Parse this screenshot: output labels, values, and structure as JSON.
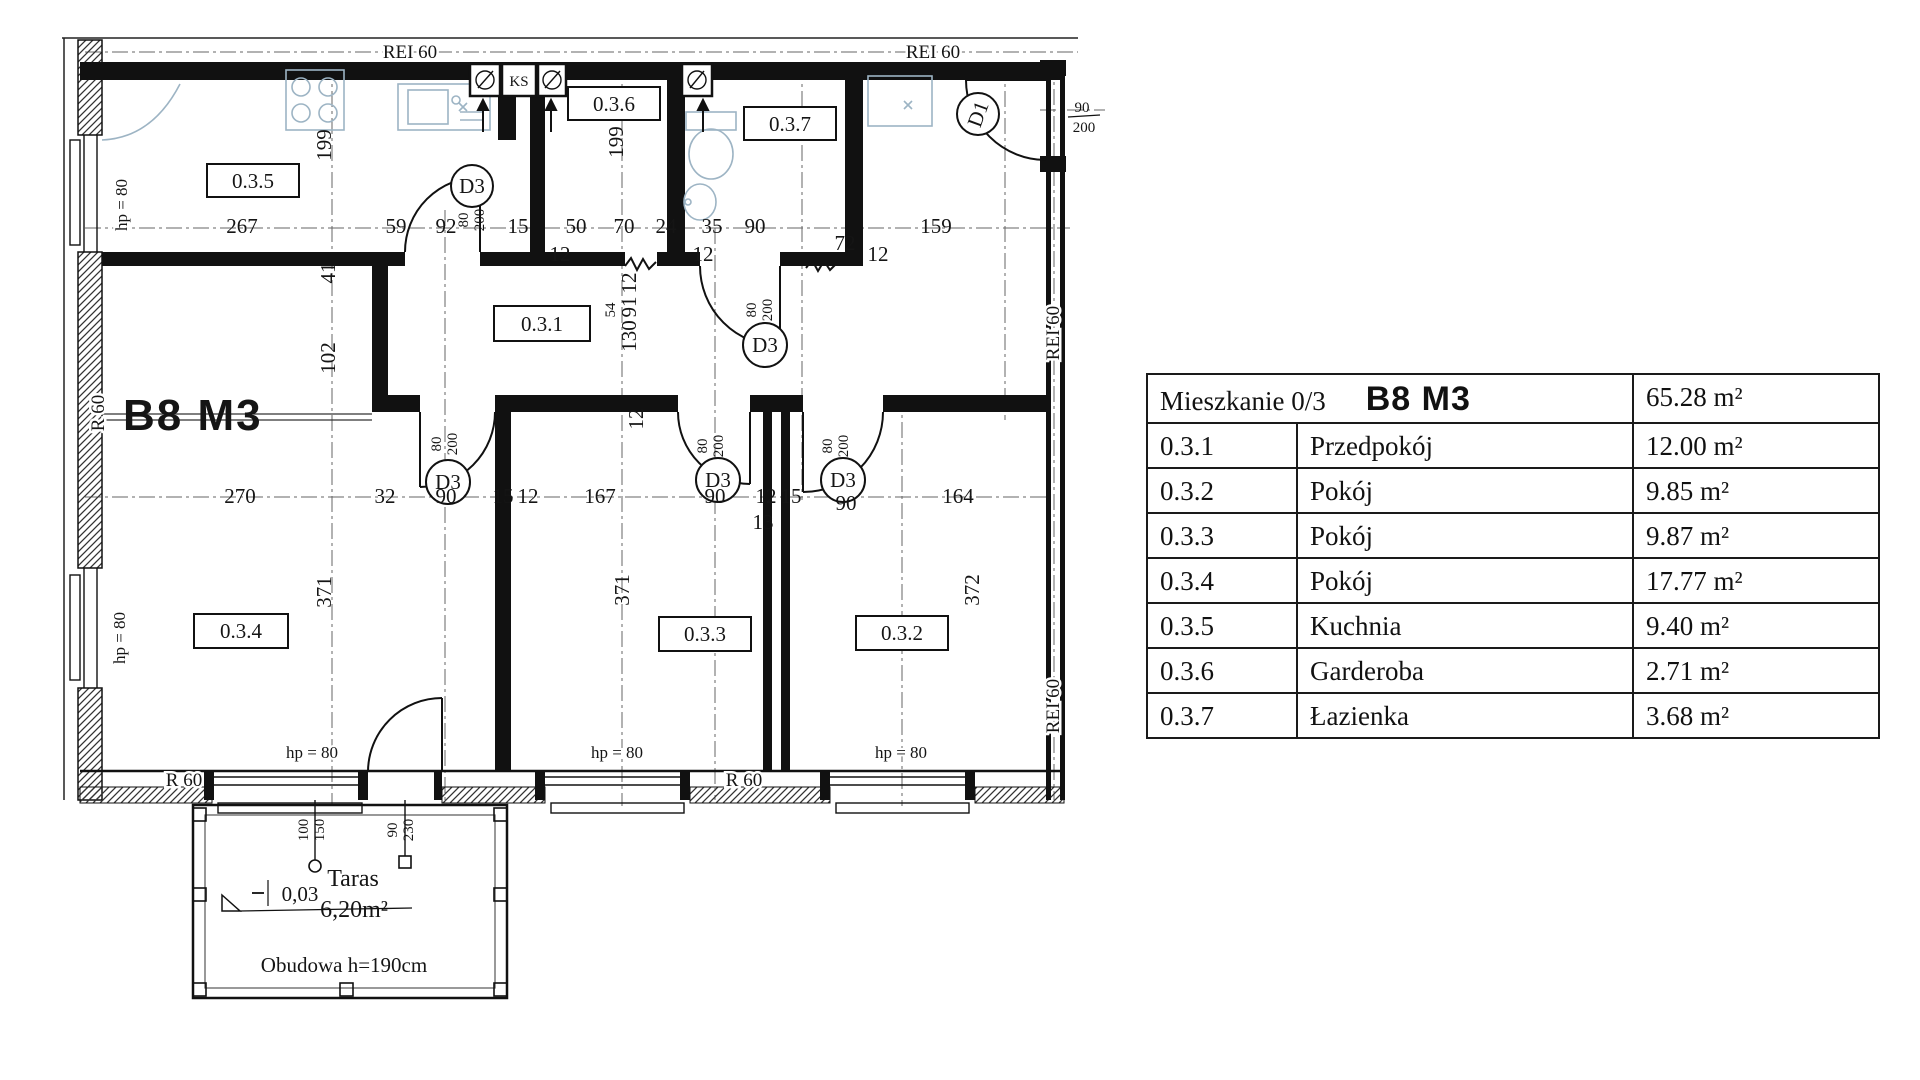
{
  "table": {
    "title_left": "Mieszkanie 0/3",
    "title_unit": "B8 M3",
    "title_area": "65.28 m²",
    "rows": [
      {
        "code": "0.3.1",
        "name": "Przedpokój",
        "area": "12.00 m²"
      },
      {
        "code": "0.3.2",
        "name": "Pokój",
        "area": "9.85 m²"
      },
      {
        "code": "0.3.3",
        "name": "Pokój",
        "area": "9.87 m²"
      },
      {
        "code": "0.3.4",
        "name": "Pokój",
        "area": "17.77 m²"
      },
      {
        "code": "0.3.5",
        "name": "Kuchnia",
        "area": "9.40 m²"
      },
      {
        "code": "0.3.6",
        "name": "Garderoba",
        "area": "2.71 m²"
      },
      {
        "code": "0.3.7",
        "name": "Łazienka",
        "area": "3.68 m²"
      }
    ]
  },
  "plan": {
    "unit_label": "B8 M3",
    "room_tags": [
      "0.3.5",
      "0.3.6",
      "0.3.7",
      "0.3.1",
      "0.3.4",
      "0.3.3",
      "0.3.2"
    ],
    "fire": {
      "rei60": "REI 60",
      "r60": "R 60"
    },
    "window_sill": "hp = 80",
    "doors": {
      "d3": "D3",
      "d1": "D1",
      "w80": "80",
      "h200": "200",
      "w90": "90"
    },
    "shaft_label": "KS",
    "dims": {
      "top": [
        "267",
        "59",
        "92",
        "15",
        "50",
        "70",
        "24",
        "35",
        "90",
        "72",
        "159"
      ],
      "top_sub": [
        "12",
        "12",
        "12"
      ],
      "mid": [
        "270",
        "32",
        "90",
        "15",
        "12",
        "167",
        "90",
        "12",
        "15",
        "90",
        "164"
      ],
      "mid_sub": "13",
      "vert": [
        "199",
        "199",
        "41",
        "102",
        "54",
        "12",
        "91",
        "130",
        "12",
        "371",
        "371",
        "372"
      ]
    },
    "terrace": {
      "name": "Taras",
      "area": "6,20m²",
      "level": "0,03",
      "enclosure": "Obudowa h=190cm",
      "dim_pairs": [
        "100",
        "150",
        "90",
        "230"
      ]
    }
  }
}
